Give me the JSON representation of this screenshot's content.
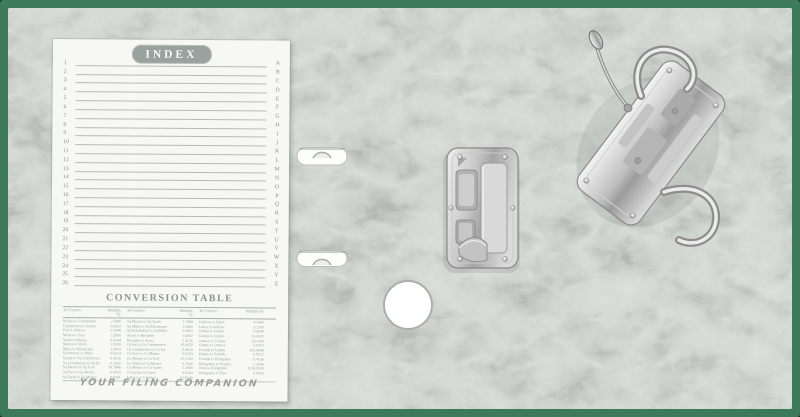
{
  "photo": {
    "subject": "open lever-arch file binder interior",
    "cover_edge_color": "#3c7a5a",
    "board_surface_color": "#d8dcd8",
    "card_color": "#f7f8f5",
    "metal_color": "#c9c9c9"
  },
  "index_card": {
    "title": "INDEX",
    "row_numbers": [
      "1",
      "2",
      "3",
      "4",
      "5",
      "6",
      "7",
      "8",
      "9",
      "10",
      "11",
      "12",
      "13",
      "14",
      "15",
      "16",
      "17",
      "18",
      "19",
      "20",
      "21",
      "22",
      "23",
      "24",
      "25",
      "26"
    ],
    "letters": [
      "A",
      "B",
      "C",
      "D",
      "E",
      "F",
      "G",
      "H",
      "I",
      "J",
      "K",
      "L",
      "M",
      "N",
      "O",
      "P",
      "Q",
      "R",
      "S",
      "T",
      "U",
      "V",
      "W",
      "X",
      "Y",
      "Z"
    ],
    "footer_text": "YOUR FILING COMPANION"
  },
  "conversion_table": {
    "title": "CONVERSION TABLE",
    "column_headers": [
      "To Convert",
      "Multiply by",
      "To Convert",
      "Multiply by",
      "To Convert",
      "Multiply by"
    ],
    "rows": [
      [
        "Inches to Centimetres",
        "2.5400",
        "Sq Metres to Sq Yards",
        "1.1960",
        "Gallons to Litres",
        "4.5460"
      ],
      [
        "Centimetres to Inches",
        "0.3937",
        "Sq Miles to Sq Kilometres",
        "2.5900",
        "Litres to Gallons",
        "0.2200"
      ],
      [
        "Feet to Metres",
        "0.3048",
        "Sq Kilometres to Sq Miles",
        "0.3861",
        "Grains to Grams",
        "0.0648"
      ],
      [
        "Metres to Feet",
        "3.2808",
        "Acres to Hectares",
        "0.4047",
        "Grams to Grains",
        "15.4320"
      ],
      [
        "Yards to Metres",
        "0.9144",
        "Hectares to Acres",
        "2.4710",
        "Ounces to Grams",
        "28.3500"
      ],
      [
        "Metres to Yards",
        "1.0936",
        "Cu Ins to Cu Centimetres",
        "16.3870",
        "Grams to Ounces",
        "0.0353"
      ],
      [
        "Miles to Kilometres",
        "1.6093",
        "Cu Centimetres to Cu Ins",
        "0.0610",
        "Pounds to Grams",
        "453.6000"
      ],
      [
        "Kilometres to Miles",
        "0.6214",
        "Cu Feet to Cu Metres",
        "0.0283",
        "Grams to Pounds",
        "0.0022"
      ],
      [
        "Sq Ins to Sq Centimetres",
        "6.4516",
        "Cu Metres to Cu Feet",
        "35.3150",
        "Pounds to Kilograms",
        "0.4536"
      ],
      [
        "Sq Centimetres to Sq Ins",
        "0.1550",
        "Cu Yards to Cu Metres",
        "0.7646",
        "Kilograms to Pounds",
        "2.2046"
      ],
      [
        "Sq Metres to Sq Feet",
        "10.7640",
        "Cu Metres to Cu Yards",
        "1.3080",
        "Tons to Kilograms",
        "1016.0500"
      ],
      [
        "Sq Feet to Sq Metres",
        "0.0929",
        "Cu Inches to Litres",
        "0.0164",
        "Kilograms to Tons",
        "0.0010"
      ],
      [
        "Sq Yards to Sq Metres",
        "0.8361",
        "Litres to Cu Inches",
        "61.0240",
        "",
        ""
      ]
    ]
  }
}
